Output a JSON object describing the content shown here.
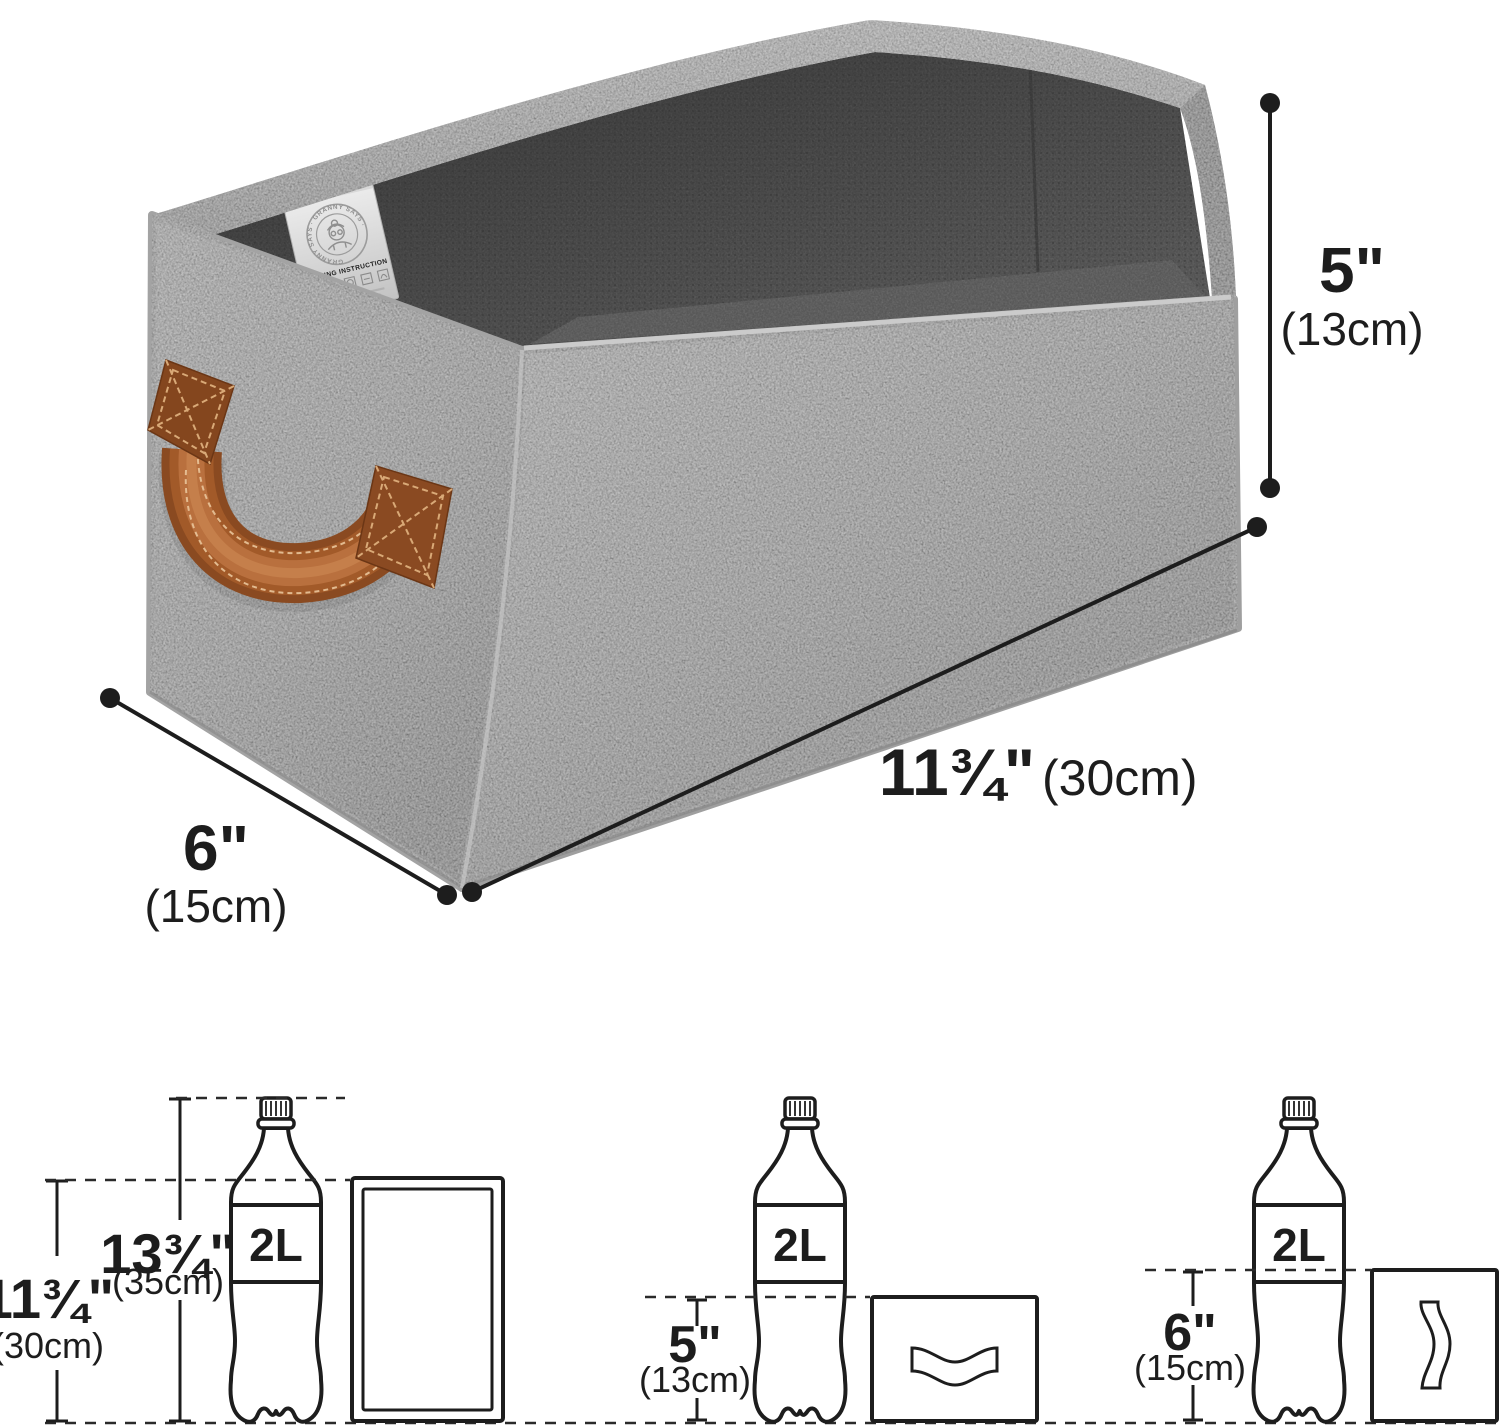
{
  "page": {
    "background": "#ffffff"
  },
  "product": {
    "name": "collapsible fabric storage bin",
    "tag": {
      "arc_text": "GRANNY SAYS · GRANNY SAYS ·",
      "washing_text": "WASHING INSTRUCTION"
    },
    "colors": {
      "fabric_light": "#b6b6b6",
      "fabric_mid": "#a1a1a1",
      "fabric_dark": "#8a8a8a",
      "interior_dark": "#474747",
      "interior_light": "#6e6e6e",
      "handle_brown": "#a05a2a",
      "tag_bg": "#dcdcdc",
      "ink": "#1d1d1d"
    }
  },
  "dimensions": {
    "height": {
      "imperial": "5\"",
      "metric": "(13cm)"
    },
    "length": {
      "imperial": "11¾\"",
      "metric": "(30cm)"
    },
    "depth": {
      "imperial": "6\"",
      "metric": "(15cm)"
    }
  },
  "size_comparison": {
    "bottle_label": "2L",
    "panels": [
      {
        "id": "folded-upright",
        "measures": [
          {
            "imperial": "11¾\"",
            "metric": "(30cm)"
          },
          {
            "imperial": "13¾\"",
            "metric": "(35cm)"
          }
        ]
      },
      {
        "id": "folded-flat",
        "measures": [
          {
            "imperial": "5\"",
            "metric": "(13cm)"
          }
        ]
      },
      {
        "id": "folded-side",
        "measures": [
          {
            "imperial": "6\"",
            "metric": "(15cm)"
          }
        ]
      }
    ]
  }
}
